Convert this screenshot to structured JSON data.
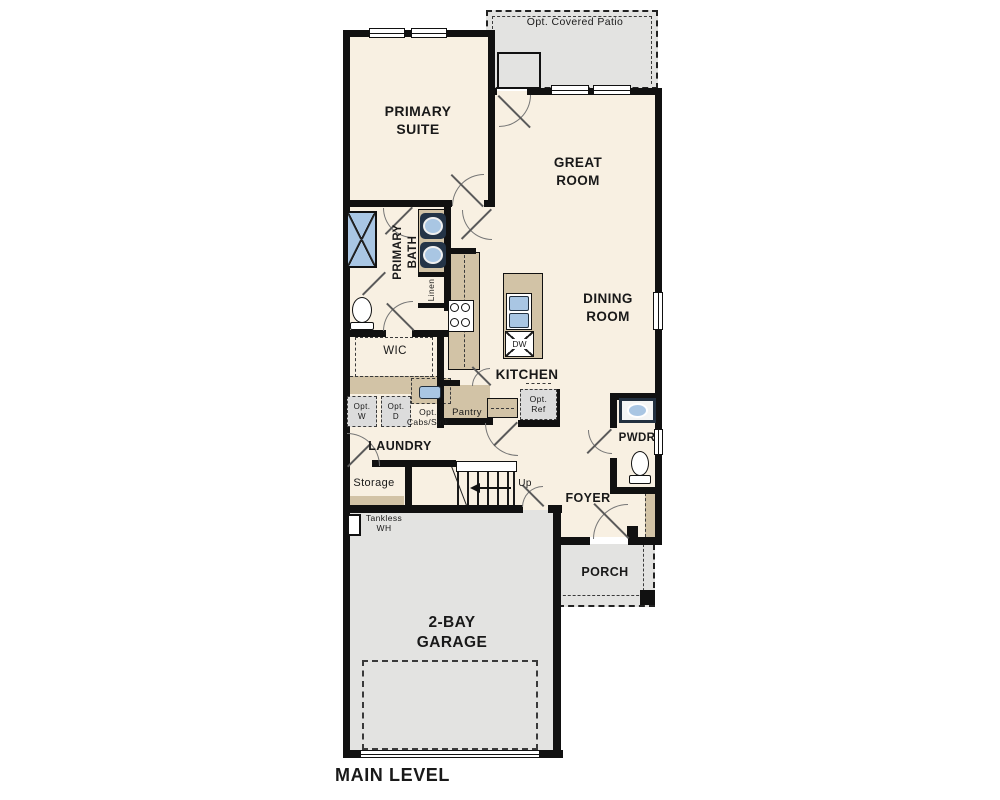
{
  "plan": {
    "title": "MAIN LEVEL",
    "rooms": {
      "patio": "Opt. Covered Patio",
      "primary_suite": "PRIMARY\nSUITE",
      "great_room": "GREAT\nROOM",
      "dining_room": "DINING\nROOM",
      "primary_bath": "PRIMARY\nBATH",
      "linen": "Linen",
      "wic": "WIC",
      "kitchen": "KITCHEN",
      "pantry": "Pantry",
      "laundry": "LAUNDRY",
      "storage": "Storage",
      "pwdr": "PWDR",
      "foyer": "FOYER",
      "porch": "PORCH",
      "garage": "2-BAY\nGARAGE"
    },
    "fixtures": {
      "dw": "DW",
      "up": "Up",
      "tankless_wh": "Tankless\nWH",
      "opt_w": "Opt.\nW",
      "opt_d": "Opt.\nD",
      "opt_cabs_sink": "Opt.\nCabs/Sink",
      "opt_ref": "Opt.\nRef"
    },
    "colors": {
      "floor": "#f8f0e2",
      "concrete": "#e3e3e1",
      "counter": "#d2c3a6",
      "fixture_blue": "#a9c6e3",
      "wall": "#111111"
    }
  }
}
